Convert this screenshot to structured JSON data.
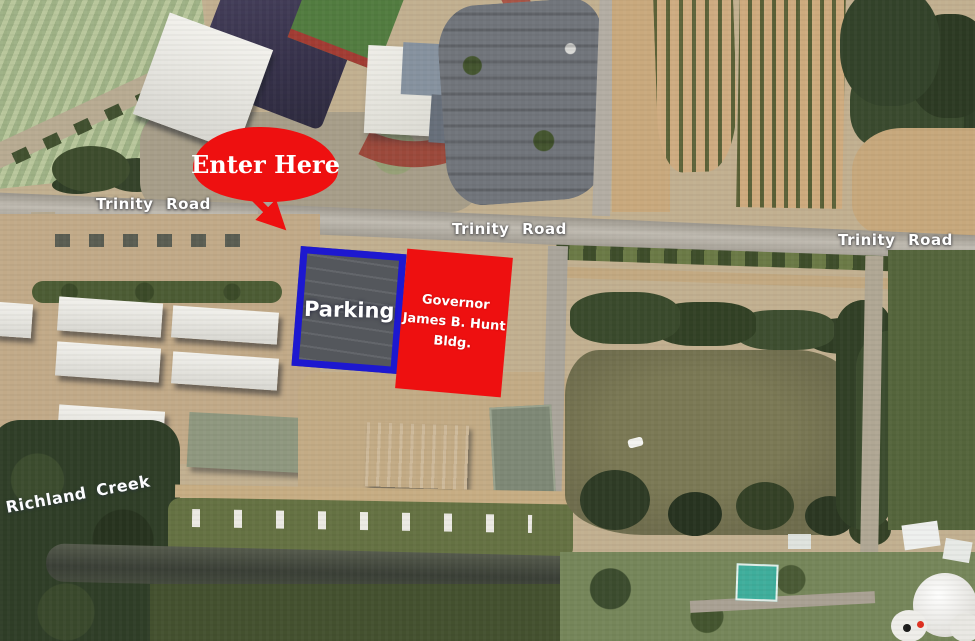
{
  "map": {
    "road_labels": [
      "Trinity Road",
      "Trinity  Road",
      "Trinity  Road"
    ],
    "annotations": {
      "enter_here": "Enter Here",
      "parking": "Parking",
      "hunt_bldg_lines": [
        "Governor",
        "James B. Hunt",
        "Bldg."
      ],
      "creek": "Richland Creek"
    },
    "colors": {
      "annotation_red": "#ee1010",
      "annotation_blue": "#1d18d0",
      "label_text": "#ffffff",
      "pond_water": "#6f6d4d"
    }
  }
}
